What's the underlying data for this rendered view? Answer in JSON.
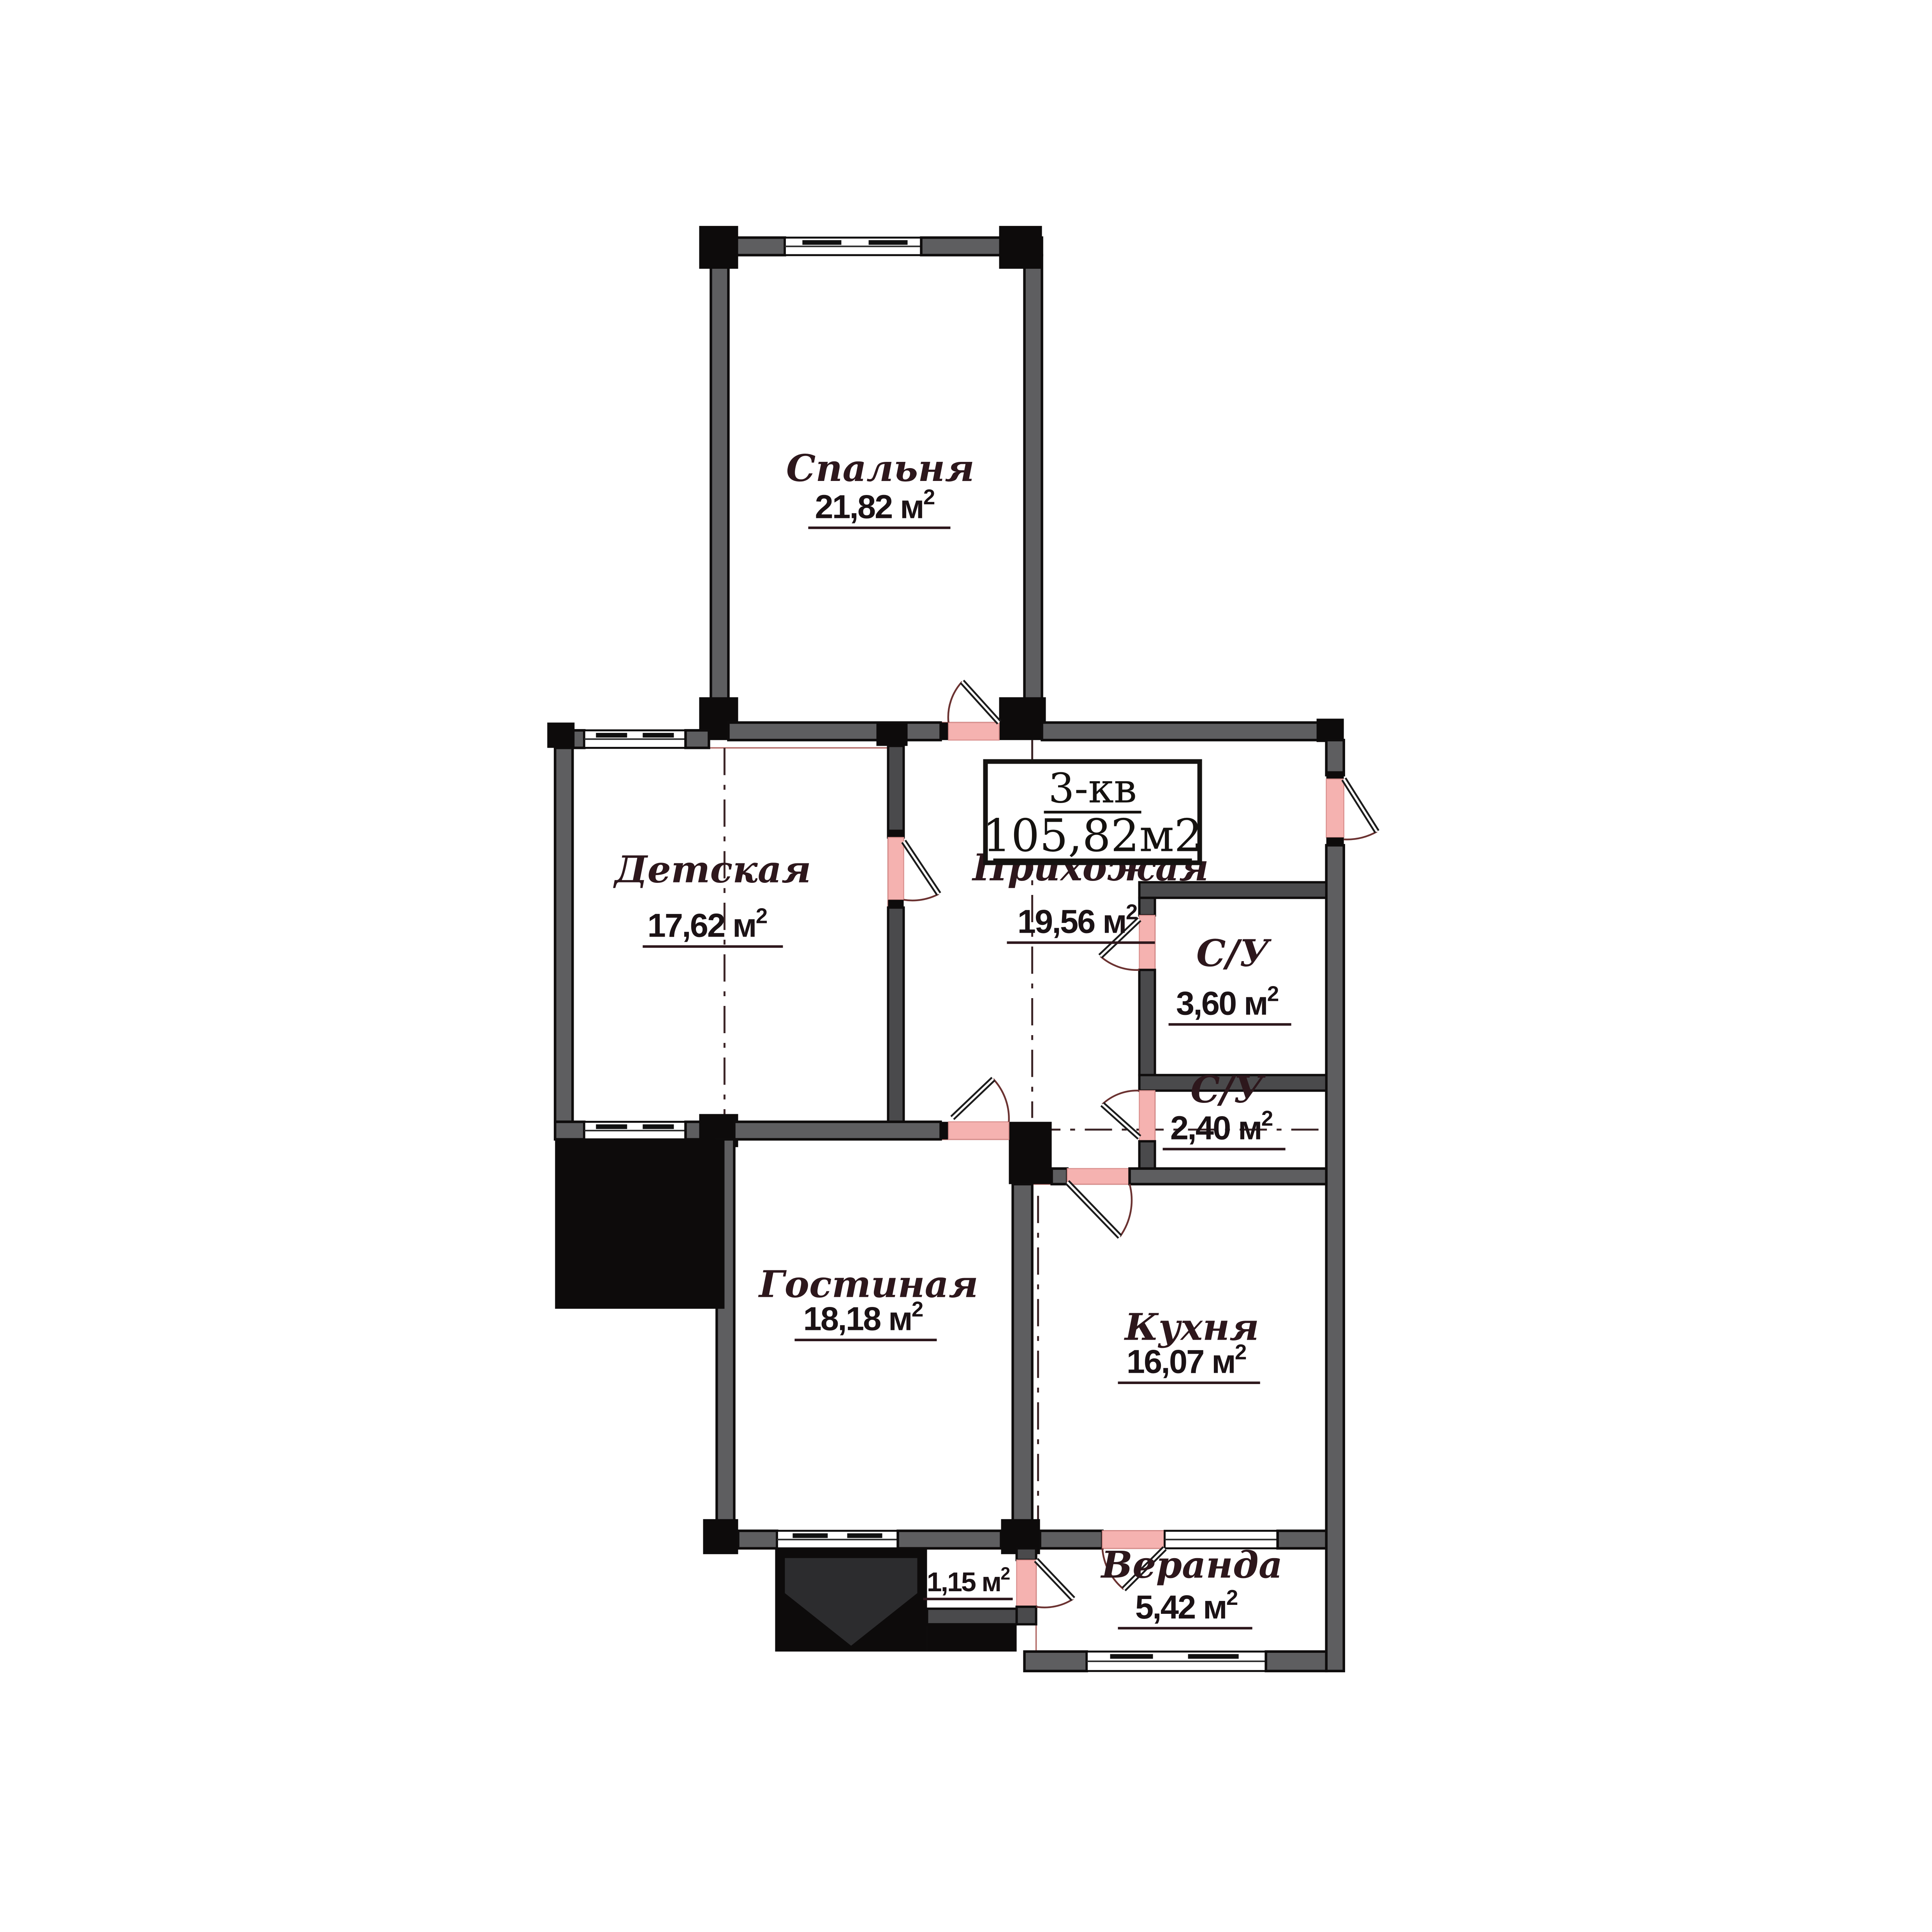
{
  "title": {
    "apartment": "3-кв",
    "total_area": "105,82м2"
  },
  "sup": "2",
  "rooms": [
    {
      "id": "spalnya",
      "name": "Спальня",
      "area": "21,82 м"
    },
    {
      "id": "detskaya",
      "name": "Детская",
      "area": "17,62 м"
    },
    {
      "id": "prihozhaya",
      "name": "Прихожая",
      "area": "19,56 м"
    },
    {
      "id": "su-1",
      "name": "С/У",
      "area": "3,60 м"
    },
    {
      "id": "su-2",
      "name": "С/У",
      "area": "2,40 м"
    },
    {
      "id": "gostinaya",
      "name": "Гостиная",
      "area": "18,18 м"
    },
    {
      "id": "kuhnya",
      "name": "Кухня",
      "area": "16,07 м"
    },
    {
      "id": "veranda",
      "name": "Веранда",
      "area": "5,42 м"
    },
    {
      "id": "storage",
      "name": "",
      "area": "1,15 м"
    }
  ],
  "colors": {
    "paper": "#ffffff",
    "wall_gray": "#5e5e60",
    "structure_black": "#0d0b0b",
    "door_opening_pink": "#f5b2b0",
    "interior_outline_red": "#b26a66"
  }
}
